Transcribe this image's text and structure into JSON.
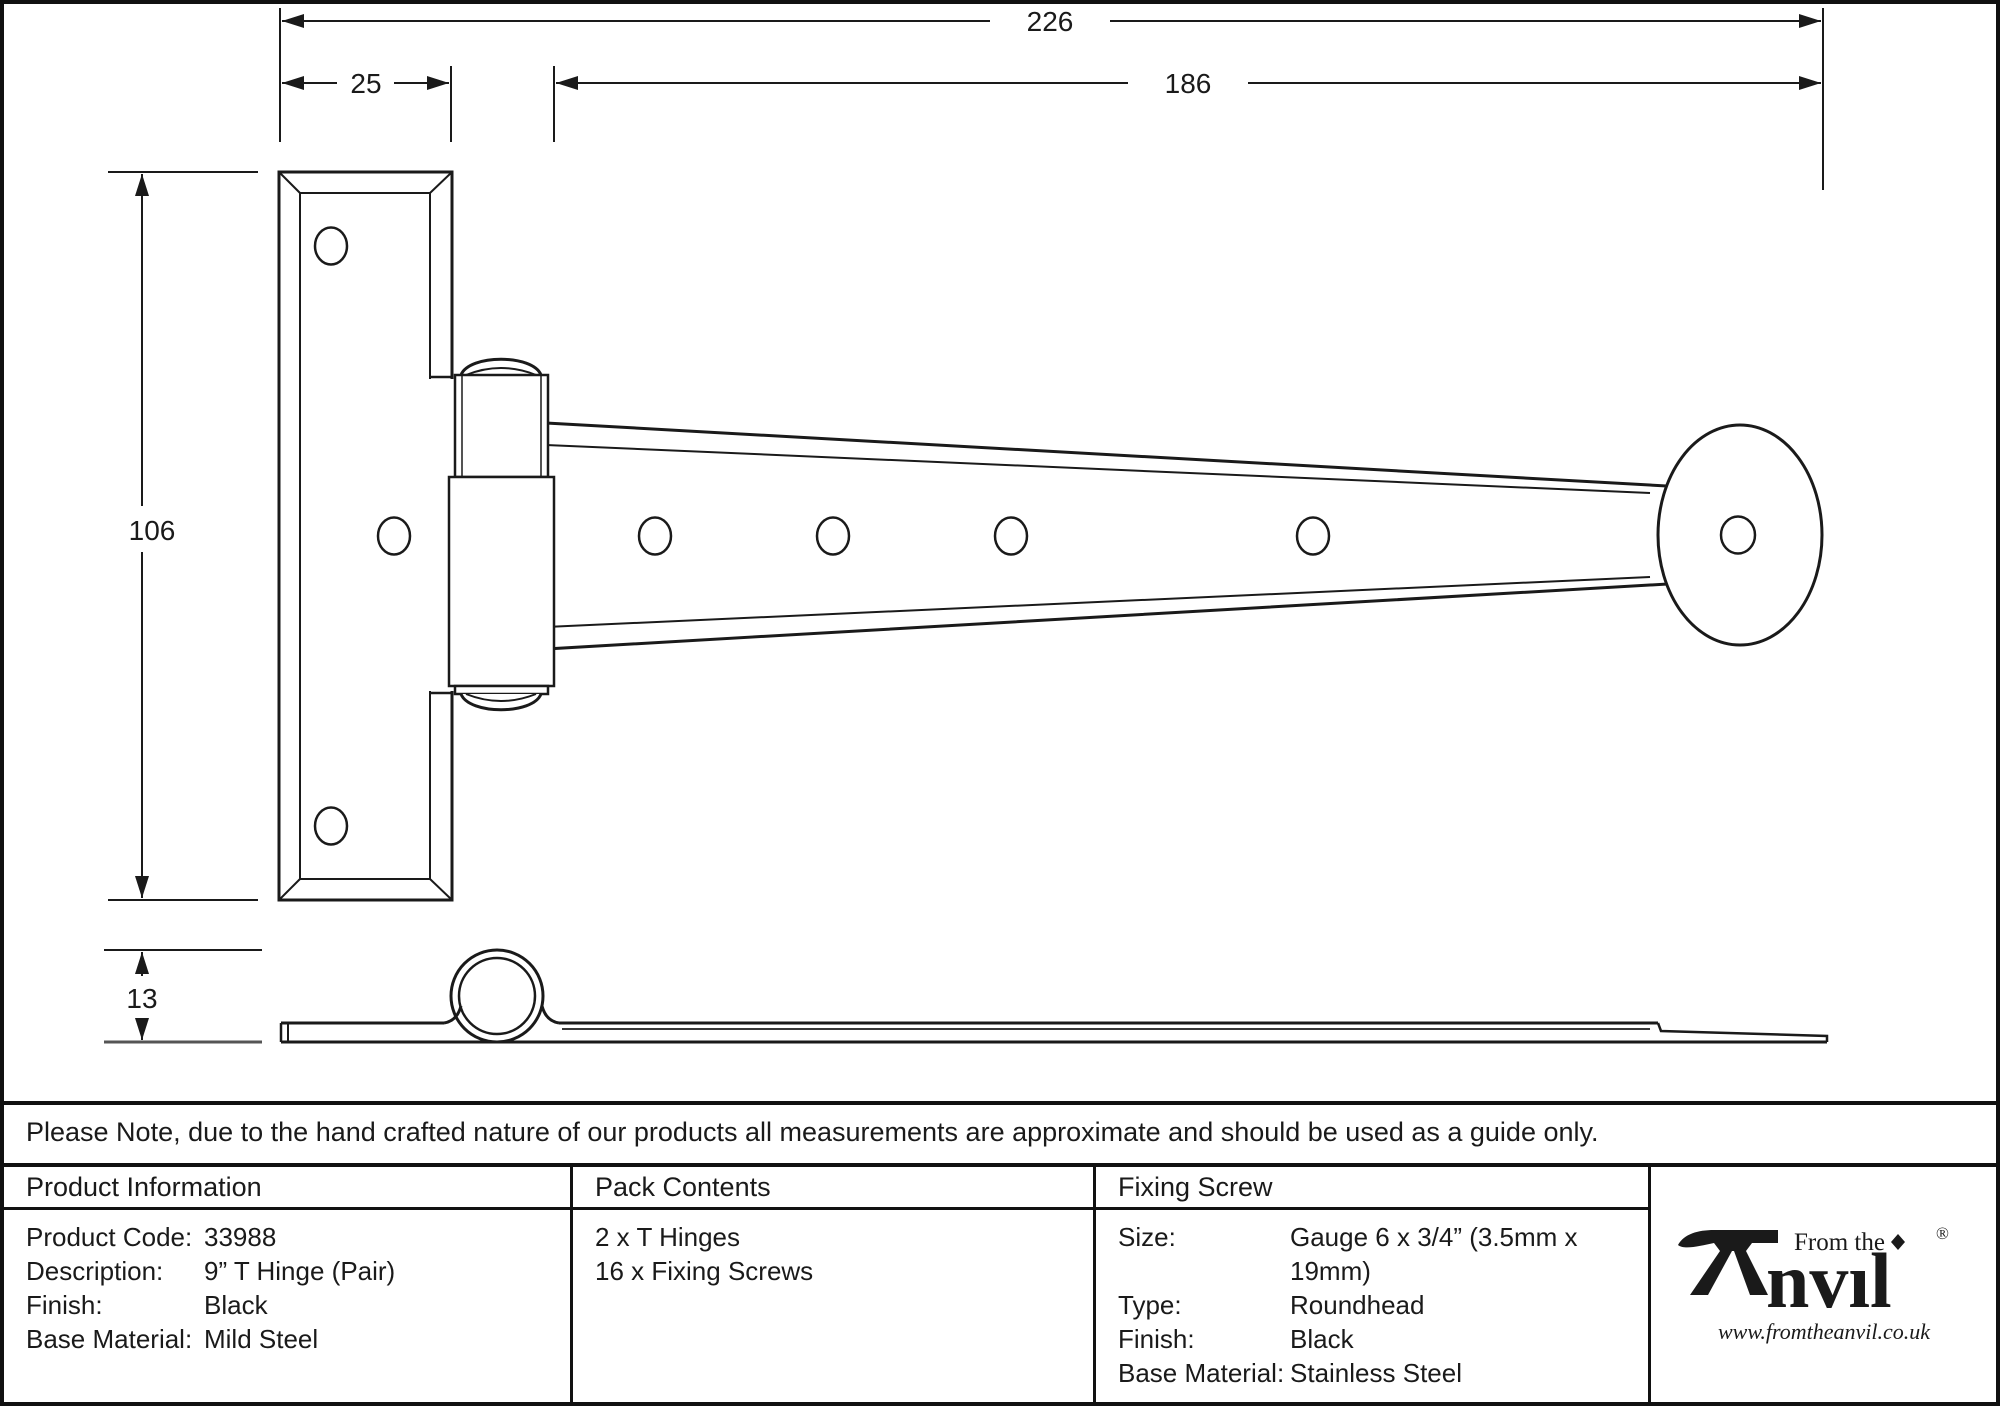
{
  "dimensions": {
    "overall_length_mm": "226",
    "strap_length_mm": "186",
    "plate_width_mm": "25",
    "plate_height_mm": "106",
    "thickness_mm": "13"
  },
  "note": "Please Note, due to the hand crafted nature of our products all measurements are approximate and should be used as a guide only.",
  "product_information": {
    "header": "Product Information",
    "rows": [
      {
        "label": "Product Code:",
        "value": "33988"
      },
      {
        "label": "Description:",
        "value": "9” T Hinge (Pair)"
      },
      {
        "label": "Finish:",
        "value": "Black"
      },
      {
        "label": "Base Material:",
        "value": "Mild Steel"
      }
    ]
  },
  "pack_contents": {
    "header": "Pack Contents",
    "items": [
      "2 x T Hinges",
      "16 x Fixing Screws"
    ]
  },
  "fixing_screw": {
    "header": "Fixing Screw",
    "rows": [
      {
        "label": "Size:",
        "value": "Gauge 6 x 3/4” (3.5mm x 19mm)"
      },
      {
        "label": "Type:",
        "value": "Roundhead"
      },
      {
        "label": "Finish:",
        "value": "Black"
      },
      {
        "label": "Base Material:",
        "value": "Stainless Steel"
      }
    ]
  },
  "logo": {
    "prefix": "From the",
    "brand": "Anvil",
    "brand_display": "nvıl",
    "registered": "®",
    "url": "www.fromtheanvil.co.uk"
  },
  "colors": {
    "line": "#1a1a1a",
    "background": "#ffffff"
  }
}
